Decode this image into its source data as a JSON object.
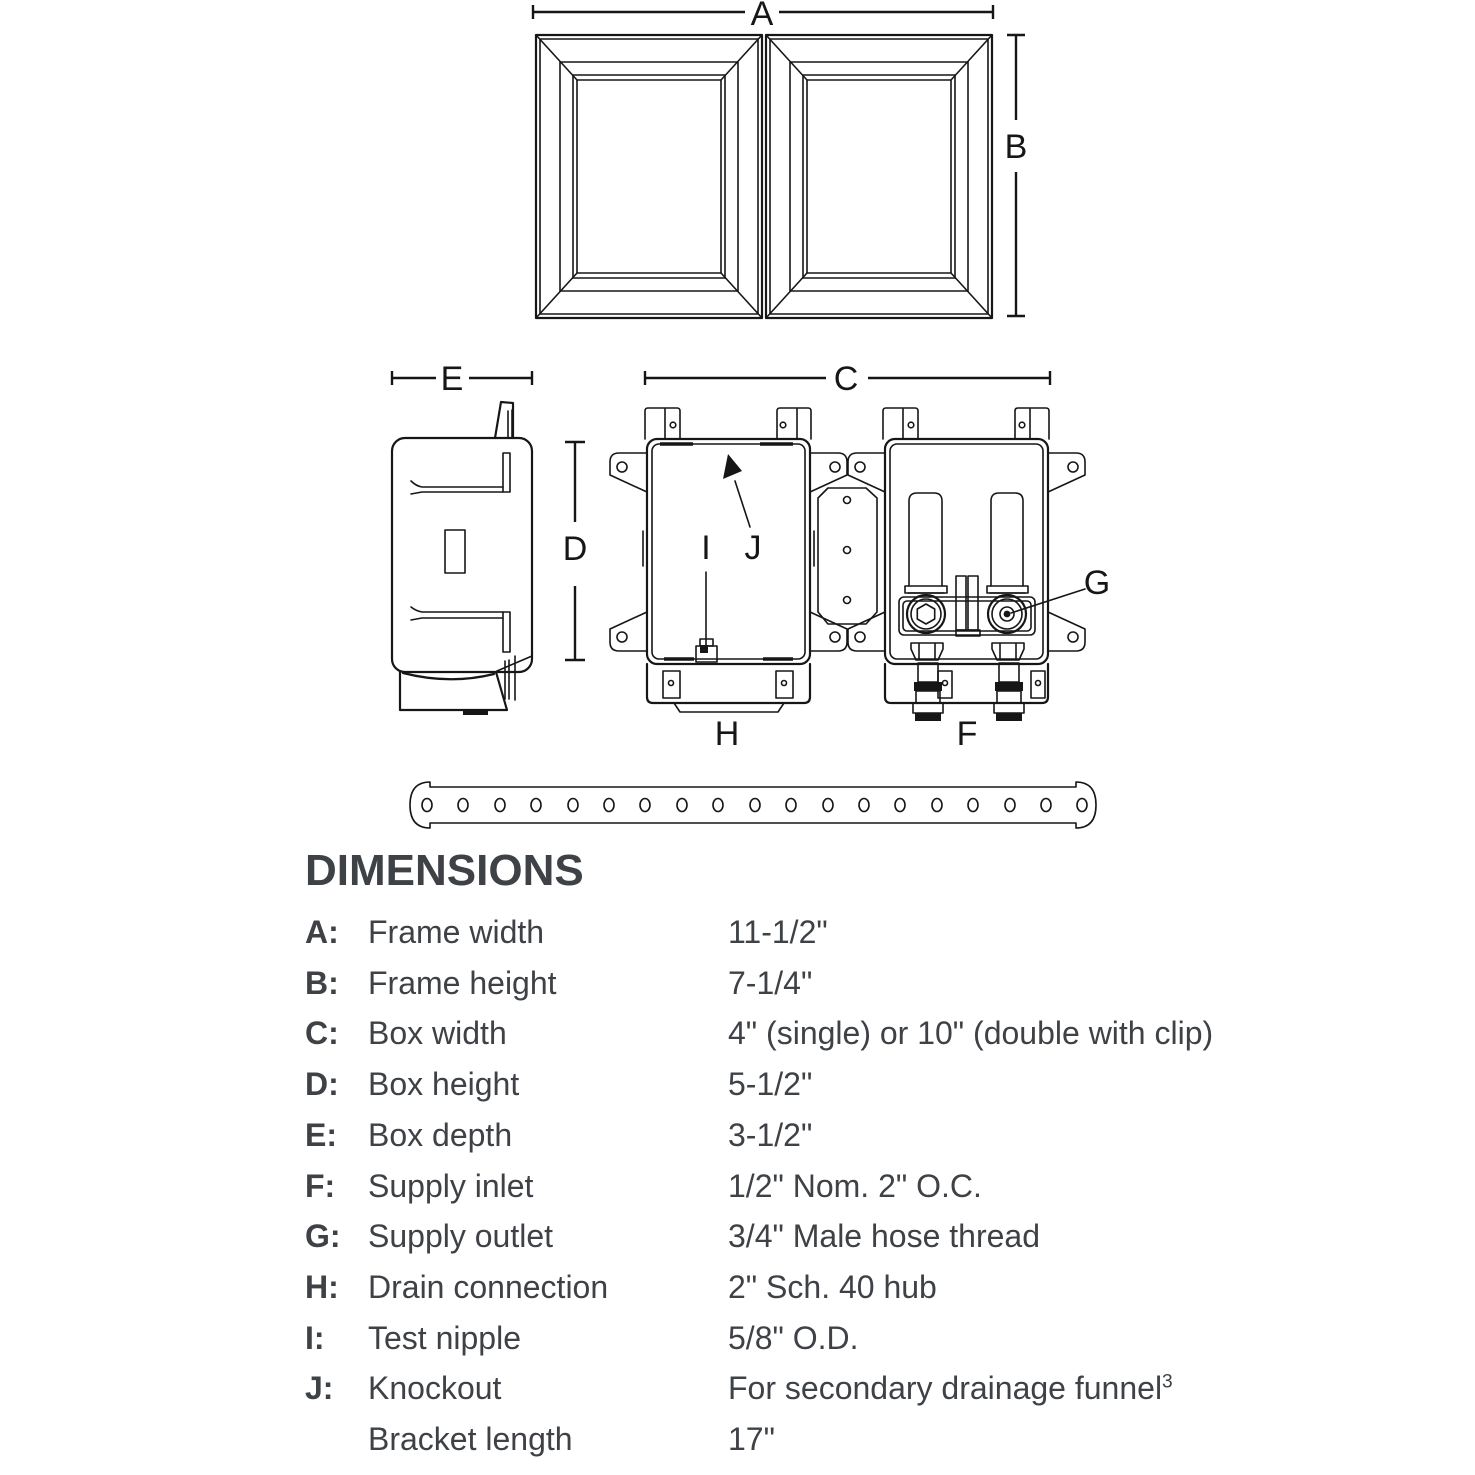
{
  "page": {
    "background": "#ffffff",
    "diagram_line_color": "#161616",
    "text_color": "#3e4246"
  },
  "diagram": {
    "labels": {
      "A": "A",
      "B": "B",
      "C": "C",
      "D": "D",
      "E": "E",
      "F": "F",
      "G": "G",
      "H": "H",
      "I": "I",
      "J": "J"
    }
  },
  "dimensions_section": {
    "heading": "DIMENSIONS",
    "rows": [
      {
        "letter": "A:",
        "name": "Frame width",
        "value": "11-1/2\""
      },
      {
        "letter": "B:",
        "name": "Frame height",
        "value": "7-1/4\""
      },
      {
        "letter": "C:",
        "name": "Box width",
        "value": "4\" (single) or 10\" (double with clip)"
      },
      {
        "letter": "D:",
        "name": "Box height",
        "value": "5-1/2\""
      },
      {
        "letter": "E:",
        "name": "Box depth",
        "value": "3-1/2\""
      },
      {
        "letter": "F:",
        "name": "Supply inlet",
        "value": "1/2\" Nom. 2\" O.C."
      },
      {
        "letter": "G:",
        "name": "Supply outlet",
        "value": "3/4\" Male hose thread"
      },
      {
        "letter": "H:",
        "name": "Drain connection",
        "value": "2\" Sch. 40 hub"
      },
      {
        "letter": "I:",
        "name": "Test nipple",
        "value": "5/8\" O.D."
      },
      {
        "letter": "J:",
        "name": "Knockout",
        "value": "For secondary drainage funnel",
        "value_sup": "3"
      },
      {
        "letter": "",
        "name": "Bracket length",
        "value": "17\""
      }
    ]
  }
}
